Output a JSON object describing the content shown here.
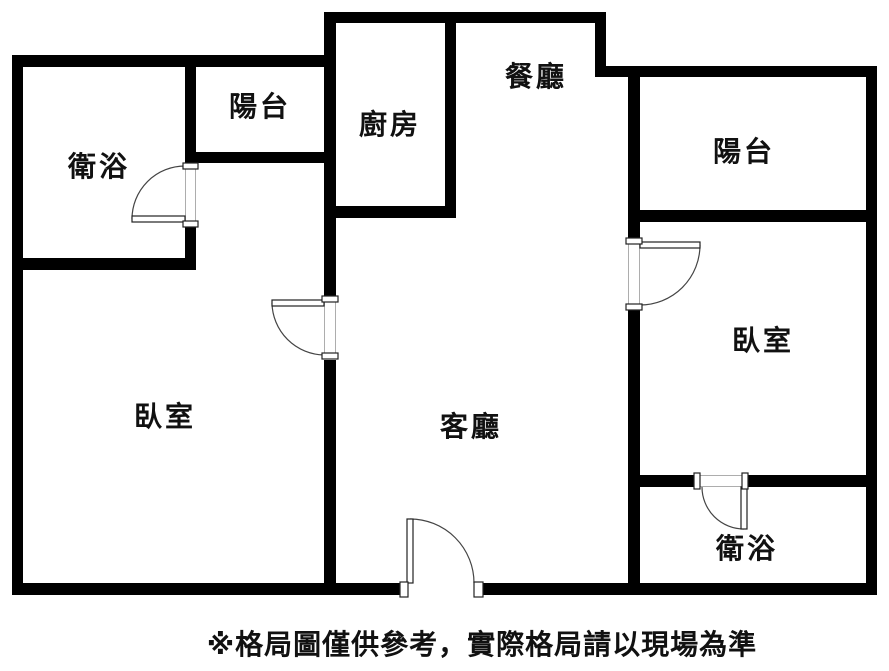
{
  "floor_plan": {
    "rooms": {
      "bathroom_top_left": "衛浴",
      "balcony_top_left": "陽台",
      "kitchen": "廚房",
      "dining_room": "餐廳",
      "balcony_right": "陽台",
      "bedroom_left": "臥室",
      "living_room": "客廳",
      "bedroom_right": "臥室",
      "bathroom_bottom_right": "衛浴"
    },
    "disclaimer": "※格局圖僅供參考，實際格局請以現場為準",
    "colors": {
      "wall": "#000000",
      "background": "#ffffff",
      "door_line": "#444444",
      "text": "#111111"
    }
  }
}
